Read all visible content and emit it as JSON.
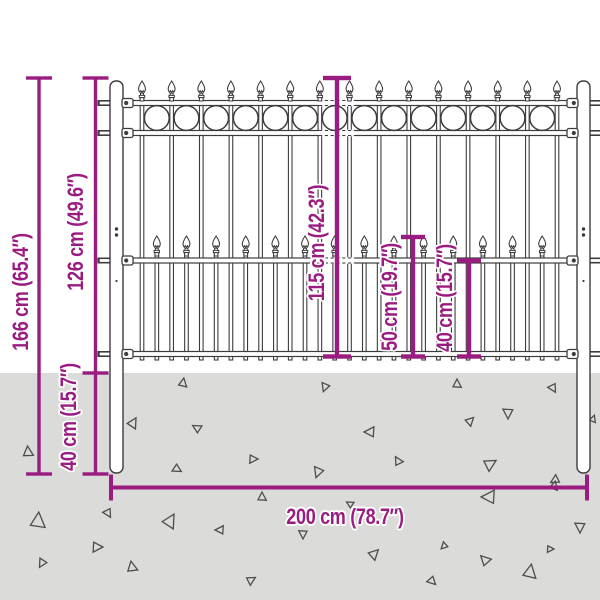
{
  "figure": {
    "type": "product-dimension-diagram",
    "subject": "steel-fence-panel-with-posts"
  },
  "colors": {
    "dimension_accent": "#9A1C80",
    "ground": "#DBDBD9",
    "fence_outline": "#3C3C3C",
    "background": "#FFFFFF"
  },
  "labels": {
    "total_height": "166 cm (65.4″)",
    "height_above_ground": "126 cm (49.6″)",
    "depth_below_ground": "40 cm (15.7″)",
    "panel_height": "115 cm (42.3″)",
    "picket_section_height": "50 cm (19.7″)",
    "bottom_section_height": "40 cm (15.7″)",
    "total_width": "200 cm (78.7″)"
  }
}
